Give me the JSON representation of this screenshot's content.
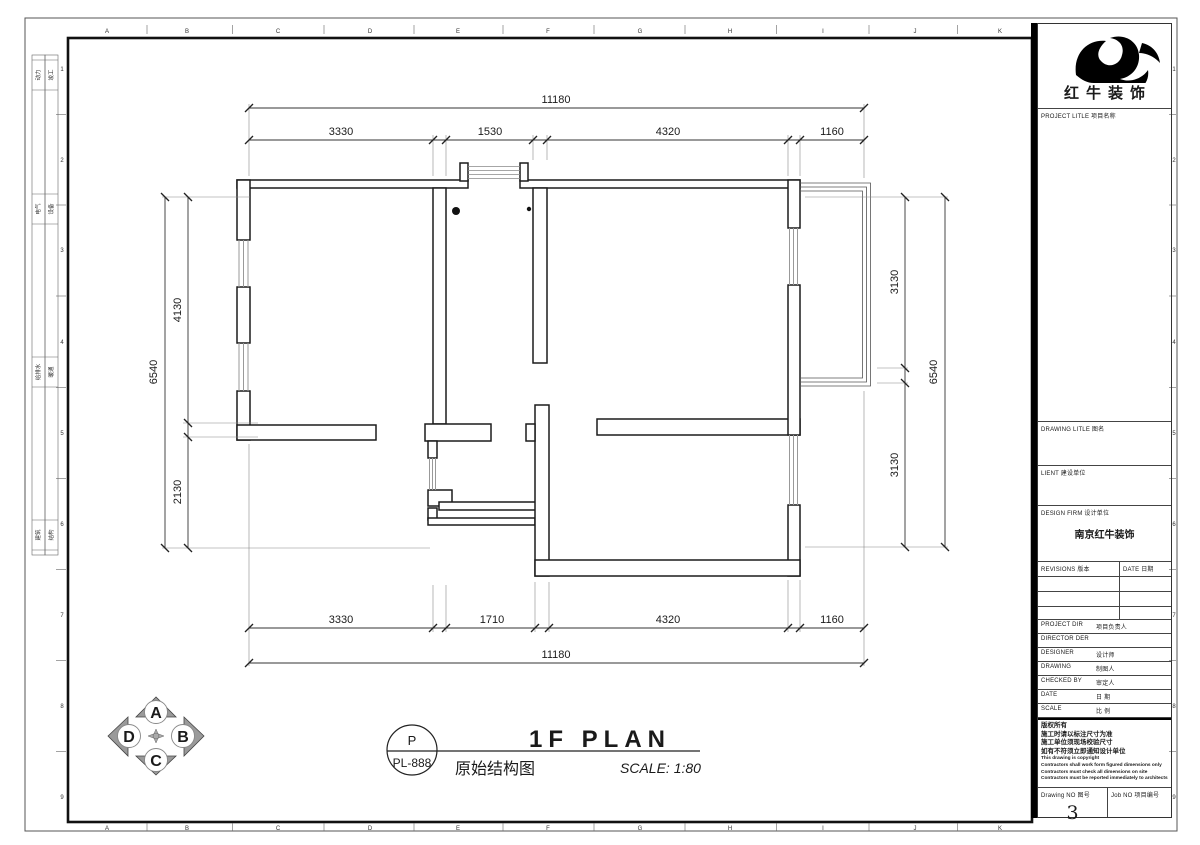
{
  "sheet": {
    "col_letters": [
      "A",
      "B",
      "C",
      "D",
      "E",
      "F",
      "G",
      "H",
      "I",
      "J",
      "K"
    ],
    "row_numbers": [
      "1",
      "2",
      "3",
      "4",
      "5",
      "6",
      "7",
      "8",
      "9"
    ]
  },
  "sidebar": {
    "stamps": [
      {
        "a": "动力",
        "b": "竣工"
      },
      {
        "a": "电气",
        "b": "设备"
      },
      {
        "a": "给排水",
        "b": "暖通"
      },
      {
        "a": "建筑",
        "b": "结构"
      }
    ]
  },
  "dims": {
    "top": {
      "total": "11180",
      "segs": [
        "3330",
        "1530",
        "4320",
        "1160"
      ]
    },
    "bottom": {
      "total": "11180",
      "segs": [
        "3330",
        "1710",
        "4320",
        "1160"
      ]
    },
    "left": {
      "total": "6540",
      "segs": [
        "4130",
        "2130"
      ]
    },
    "right": {
      "total": "6540",
      "segs": [
        "3130",
        "3130"
      ]
    }
  },
  "compass": {
    "n": "A",
    "e": "B",
    "s": "C",
    "w": "D"
  },
  "titlebar": {
    "code_top": "P",
    "code": "PL-888",
    "title": "1F PLAN",
    "subtitle": "原始结构图",
    "scale": "SCALE: 1:80"
  },
  "titleblock": {
    "brand": "红牛装饰",
    "project_label": "PROJECT LITLE  项目名称",
    "drawing_label": "DRAWING LITLE  图名",
    "client_label": "LIENT  建设单位",
    "firm_label": "DESIGN FIRM  设计单位",
    "firm_value": "南京红牛装饰",
    "rev_label": "REVISIONS  版本",
    "rev_date_label": "DATE  日期",
    "rows": [
      {
        "en": "PROJECT DIR",
        "zh": "项目负责人"
      },
      {
        "en": "DIRECTOR DER",
        "zh": ""
      },
      {
        "en": "DESIGNER",
        "zh": "设计师"
      },
      {
        "en": "DRAWING",
        "zh": "制图人"
      },
      {
        "en": "CHECKED BY",
        "zh": "审定人"
      },
      {
        "en": "DATE",
        "zh": "日  期"
      },
      {
        "en": "SCALE",
        "zh": "比  例"
      }
    ],
    "copyright_zh": [
      "版权所有",
      "施工时请以标注尺寸为准",
      "施工单位须现场校验尺寸",
      "如有不符须立即通知设计单位"
    ],
    "copyright_en": [
      "This drawing is copyright",
      "Contractors shall work form figured dimensions only",
      "Contractors must check all dimensions on site",
      "Contractors must be reported immediately to architects"
    ],
    "drawing_no_label": "Drawing NO 图号",
    "drawing_no": "3",
    "job_no_label": "Job NO 项目编号"
  },
  "colors": {
    "wall_line": "#1c1c1c",
    "dim_line": "#333333",
    "window_line": "#999999",
    "accent": "#000000"
  }
}
